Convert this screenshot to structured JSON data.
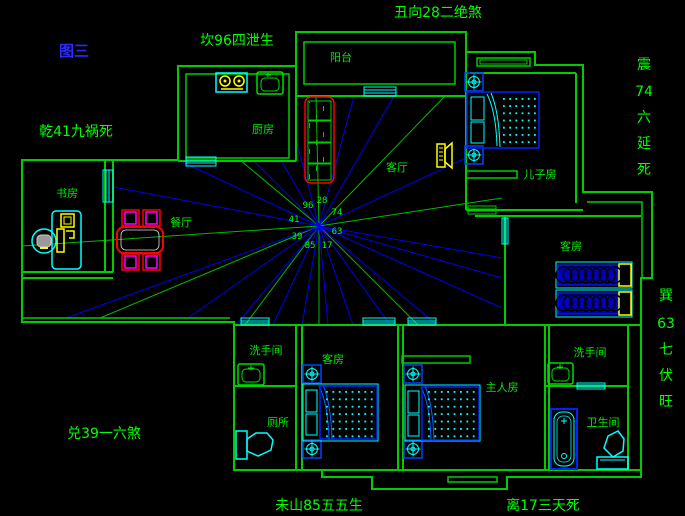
{
  "figure_label": "图三",
  "annotations": {
    "north": "坎96四泄生",
    "northeast": "丑向28二绝煞",
    "west_upper": "乾41九祸死",
    "west_lower": "兑39一六煞",
    "south_mountain": "未山85五五生",
    "south": "离17三天死",
    "east": {
      "text": "震74六延死",
      "chars": [
        "震",
        "74",
        "六",
        "延",
        "死"
      ]
    },
    "southeast": {
      "text": "巽63七伏旺",
      "chars": [
        "巽",
        "63",
        "七",
        "伏",
        "旺"
      ]
    }
  },
  "compass": {
    "numbers": {
      "w": "41",
      "nw": "96",
      "n": "28",
      "ne": "74",
      "e": "63",
      "se": "17",
      "s": "85",
      "sw": "39"
    }
  },
  "rooms": {
    "balcony": "阳台",
    "kitchen": "厨房",
    "living": "客厅",
    "son": "儿子房",
    "study": "书房",
    "dining": "餐厅",
    "guest_right": "客房",
    "guest_bottom": "客房",
    "washroom_left": "洗手间",
    "washroom_right": "洗手间",
    "master": "主人房",
    "toilet": "厕所",
    "bathroom": "卫生间"
  },
  "colors": {
    "wall_green": "#00cc00",
    "text_green": "#00ff00",
    "figure_blue": "#2b2bff",
    "ray_blue": "#0000ee",
    "ray_green": "#00bb00",
    "cyan": "#00ffff",
    "furniture_blue": "#0022ff",
    "red": "#ff0000",
    "magenta": "#ff00ff",
    "yellow": "#ffff00"
  }
}
